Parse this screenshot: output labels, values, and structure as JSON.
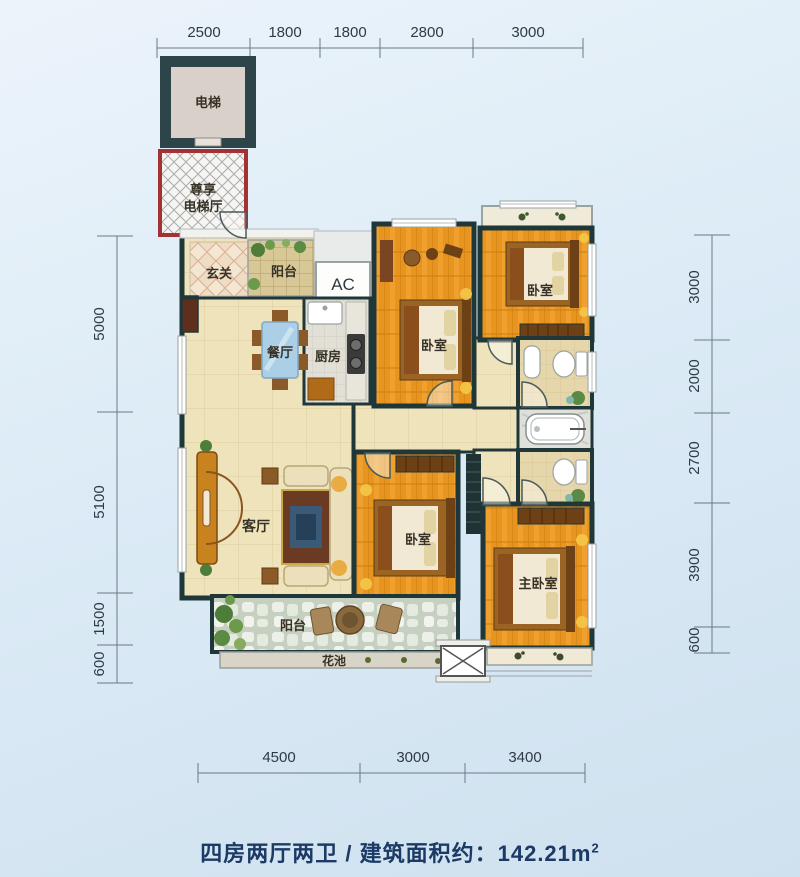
{
  "plan": {
    "type": "apartment-floor-plan",
    "dimensions_mm": {
      "top": [
        "2500",
        "1800",
        "1800",
        "2800",
        "3000"
      ],
      "left": [
        "5000",
        "5100",
        "1500",
        "600"
      ],
      "right": [
        "3000",
        "2000",
        "2700",
        "3900",
        "600"
      ],
      "bottom": [
        "4500",
        "3000",
        "3400"
      ]
    },
    "rooms": {
      "elevator": "电梯",
      "elevator_hall_line1": "尊享",
      "elevator_hall_line2": "电梯厅",
      "entrance": "玄关",
      "balcony_top": "阳台",
      "ac": "AC",
      "dining": "餐厅",
      "kitchen": "厨房",
      "bedroom_top_mid": "卧室",
      "bedroom_top_right": "卧室",
      "bedroom_bottom_mid": "卧室",
      "master_bedroom": "主卧室",
      "living": "客厅",
      "balcony_bottom": "阳台",
      "flower_bed": "花池"
    },
    "colors": {
      "background_blue": "#dcebf6",
      "wall_dark": "#20373a",
      "elevator_hall_red": "#a23233",
      "wood_floor": "#e8951f",
      "tile_cream": "#efe3bb",
      "caption_navy": "#1c3a66"
    }
  },
  "caption": {
    "text": "四房两厅两卫 / 建筑面积约：142.21m",
    "sup": "2"
  }
}
